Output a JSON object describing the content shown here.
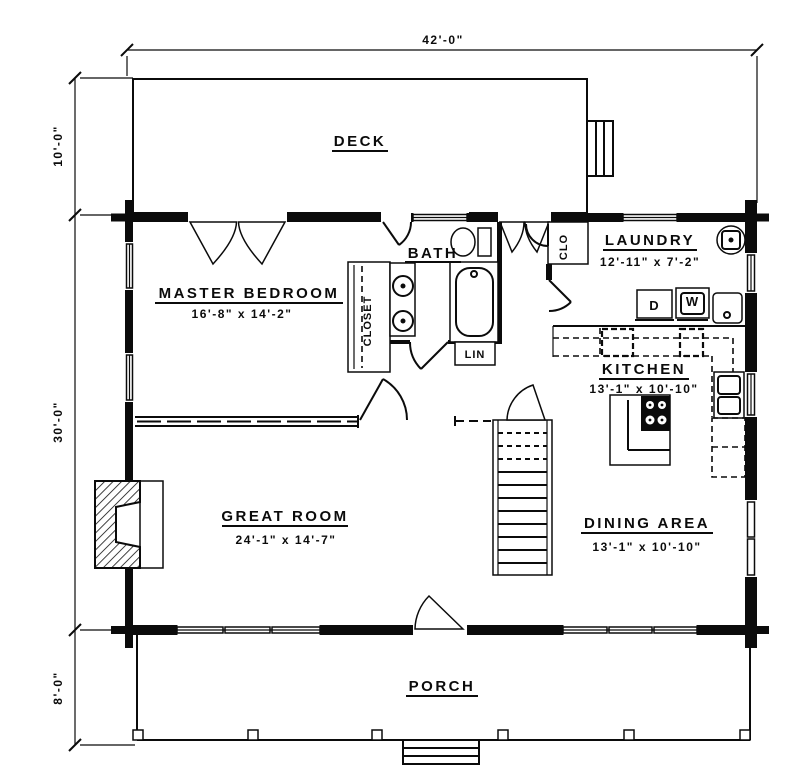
{
  "drawing": {
    "type": "first-floor plan, log home",
    "labels": {
      "deck": "DECK",
      "master_bedroom": "MASTER BEDROOM",
      "master_bedroom_size": "16'-8\" x 14'-2\"",
      "bath": "BATH",
      "closet": "CLOSET",
      "clo": "CLO",
      "lin": "LIN",
      "laundry": "LAUNDRY",
      "laundry_size": "12'-11\" x 7'-2\"",
      "kitchen": "KITCHEN",
      "kitchen_size": "13'-1\" x 10'-10\"",
      "great_room": "GREAT ROOM",
      "great_room_size": "24'-1\" x 14'-7\"",
      "dining": "DINING AREA",
      "dining_size": "13'-1\" x 10'-10\"",
      "porch": "PORCH",
      "dryer": "D",
      "washer": "W"
    },
    "dimensions": {
      "overall_width": "42'-0\"",
      "deck_depth": "10'-0\"",
      "main_depth": "30'-0\"",
      "porch_depth": "8'-0\""
    },
    "colors": {
      "ink": "#0b0b0b",
      "paper": "#ffffff"
    }
  }
}
